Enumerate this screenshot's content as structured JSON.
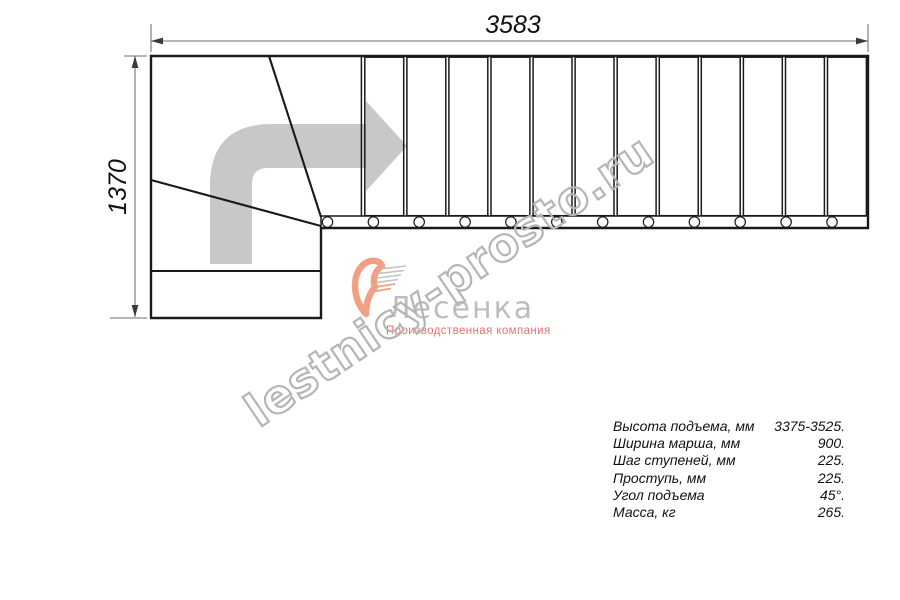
{
  "dimensions": {
    "width_label": "3583",
    "height_label": "1370"
  },
  "watermark": {
    "text": "lestnicy-prosto.ru"
  },
  "logo": {
    "name": "Лесенка",
    "tagline": "Производственная компания"
  },
  "specs": {
    "rows": [
      {
        "label": "Высота подъема, мм",
        "value": "3375-3525."
      },
      {
        "label": "Ширина марша, мм",
        "value": "900."
      },
      {
        "label": "Шаг ступеней, мм",
        "value": "225."
      },
      {
        "label": "Проступь, мм",
        "value": "225."
      },
      {
        "label": "Угол подъема",
        "value": "45°."
      },
      {
        "label": "Масса, кг",
        "value": "265."
      }
    ]
  },
  "plan": {
    "type": "quarter-turn staircase plan, top view",
    "tread_count": 12,
    "baluster_count": 12,
    "winder_count": 3,
    "colors": {
      "line": "#1a1a1a",
      "dimension": "#8a8a8a",
      "direction_arrow": "#c8c8c8",
      "watermark_outline": "#b5b5b5",
      "logo_gray": "#bdbdbd",
      "logo_accent": "#f2a083",
      "tagline": "#e3756e"
    }
  }
}
